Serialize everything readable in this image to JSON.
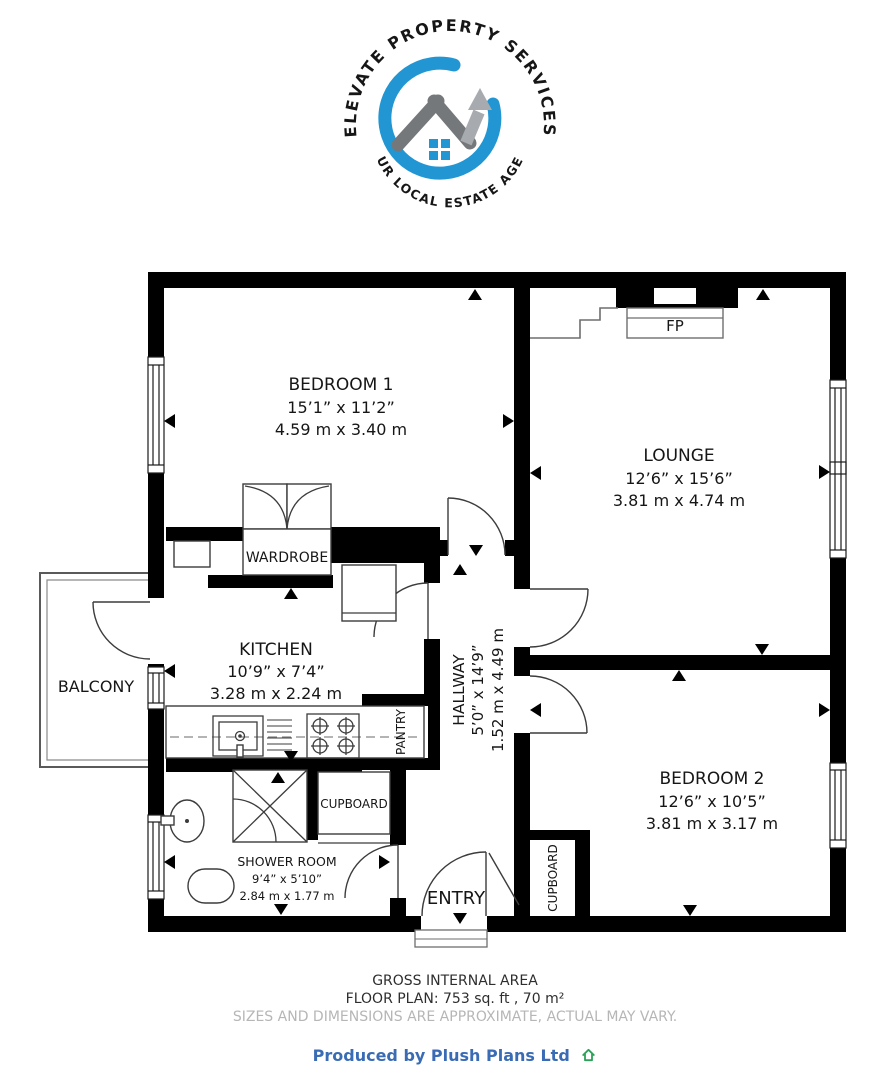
{
  "logo": {
    "arc_top": "ELEVATE PROPERTY SERVICES",
    "arc_bottom": "YOUR LOCAL ESTATE AGENT"
  },
  "colors": {
    "logo_blue": "#2196d3",
    "logo_gray": "#8a8d90",
    "arrow_silver": "#a7abaf",
    "roof_gray": "#75787b",
    "credit_blue": "#3a6cb5",
    "credit_house_green": "#2ba157",
    "disclaimer_gray": "#b6b6b6",
    "wall_black": "#000000"
  },
  "rooms": {
    "bedroom1": {
      "name": "BEDROOM 1",
      "imperial": "15’1” x 11’2”",
      "metric": "4.59 m x 3.40 m"
    },
    "lounge": {
      "name": "LOUNGE",
      "imperial": "12’6” x 15’6”",
      "metric": "3.81 m x 4.74 m"
    },
    "kitchen": {
      "name": "KITCHEN",
      "imperial": "10’9” x 7’4”",
      "metric": "3.28 m x 2.24 m"
    },
    "hallway": {
      "name": "HALLWAY",
      "imperial": "5’0” x 14’9”",
      "metric": "1.52 m x 4.49 m"
    },
    "bedroom2": {
      "name": "BEDROOM 2",
      "imperial": "12’6” x 10’5”",
      "metric": "3.81 m x 3.17 m"
    },
    "shower_room": {
      "name": "SHOWER ROOM",
      "imperial": "9’4” x 5’10”",
      "metric": "2.84 m x 1.77 m"
    },
    "balcony": {
      "name": "BALCONY"
    },
    "entry": {
      "name": "ENTRY"
    }
  },
  "features": {
    "wardrobe": "WARDROBE",
    "pantry": "PANTRY",
    "cupboard_shower": "CUPBOARD",
    "cupboard_hall": "CUPBOARD",
    "fireplace": "FP"
  },
  "footer": {
    "area_title": "GROSS INTERNAL AREA",
    "area_detail": "FLOOR PLAN: 753 sq. ft , 70 m²",
    "disclaimer": "SIZES AND DIMENSIONS ARE APPROXIMATE, ACTUAL MAY VARY.",
    "credit": "Produced by Plush Plans Ltd"
  }
}
